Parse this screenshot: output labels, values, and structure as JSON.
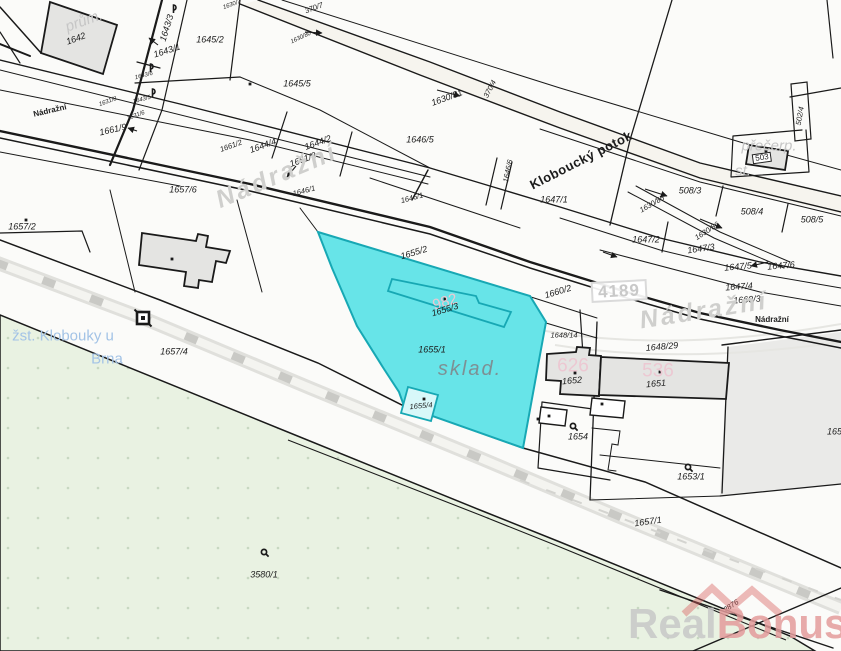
{
  "map": {
    "type": "cadastral-map",
    "selected_parcel": {
      "number": "1655/1",
      "area_use_label": "sklad.",
      "building_parcels": [
        "1655/3",
        "1655/4"
      ],
      "highlight_fill": "#67e4e8",
      "highlight_stroke": "#17a8b4"
    },
    "street_names": [
      "Nádražní"
    ],
    "stream_name": "Kloboucký potok",
    "station_name": {
      "line1": "žst. Klobouky u",
      "line2": "Brna"
    },
    "road_number": "4189",
    "labels": [
      {
        "t": "prům.",
        "x": 84,
        "y": 21,
        "r": -20,
        "c": "bname"
      },
      {
        "t": "1642",
        "x": 76,
        "y": 39,
        "r": -20,
        "c": "p"
      },
      {
        "t": "1643/3",
        "x": 167,
        "y": 28,
        "r": -73,
        "c": "p"
      },
      {
        "t": "1643/1",
        "x": 167,
        "y": 51,
        "r": -18,
        "c": "p"
      },
      {
        "t": "1643/6",
        "x": 144,
        "y": 76,
        "r": -15,
        "c": "pt"
      },
      {
        "t": "1643/5",
        "x": 142,
        "y": 100,
        "r": -15,
        "c": "pt"
      },
      {
        "t": "1645/2",
        "x": 210,
        "y": 40,
        "r": 0,
        "c": "p"
      },
      {
        "t": "1645/5",
        "x": 297,
        "y": 84,
        "r": 0,
        "c": "p"
      },
      {
        "t": "370/7",
        "x": 314,
        "y": 8,
        "r": -20,
        "c": "ps"
      },
      {
        "t": "1630/7",
        "x": 232,
        "y": 5,
        "r": -20,
        "c": "pt"
      },
      {
        "t": "1630/80",
        "x": 301,
        "y": 38,
        "r": -25,
        "c": "pt"
      },
      {
        "t": "1630/81",
        "x": 447,
        "y": 98,
        "r": -20,
        "c": "p"
      },
      {
        "t": "370/4",
        "x": 490,
        "y": 89,
        "r": -62,
        "c": "ps"
      },
      {
        "t": "1646/5",
        "x": 420,
        "y": 140,
        "r": 0,
        "c": "p"
      },
      {
        "t": "1644/4",
        "x": 263,
        "y": 146,
        "r": -20,
        "c": "p"
      },
      {
        "t": "1644/2",
        "x": 318,
        "y": 143,
        "r": -20,
        "c": "p"
      },
      {
        "t": "1661/8",
        "x": 303,
        "y": 160,
        "r": -20,
        "c": "p"
      },
      {
        "t": "1661/9",
        "x": 113,
        "y": 130,
        "r": -13,
        "c": "p"
      },
      {
        "t": "1661/2",
        "x": 231,
        "y": 146,
        "r": -20,
        "c": "ps"
      },
      {
        "t": "1631/8",
        "x": 108,
        "y": 102,
        "r": -20,
        "c": "pt"
      },
      {
        "t": "1631/6",
        "x": 136,
        "y": 116,
        "r": -20,
        "c": "pt"
      },
      {
        "t": "Nádražní",
        "x": 50,
        "y": 111,
        "r": -13,
        "c": "ssm"
      },
      {
        "t": "1646/1",
        "x": 304,
        "y": 191,
        "r": -15,
        "c": "ps"
      },
      {
        "t": "1646/1",
        "x": 412,
        "y": 198,
        "r": -15,
        "c": "ps"
      },
      {
        "t": "1646/6",
        "x": 508,
        "y": 171,
        "r": -78,
        "c": "ps"
      },
      {
        "t": "1657/6",
        "x": 183,
        "y": 190,
        "r": 0,
        "c": "p"
      },
      {
        "t": "1657/2",
        "x": 22,
        "y": 227,
        "r": 0,
        "c": "p"
      },
      {
        "t": "Nádražní",
        "x": 277,
        "y": 176,
        "r": -23,
        "c": "sbig"
      },
      {
        "t": "Kloboucký potok",
        "x": 581,
        "y": 160,
        "r": -27,
        "c": "stream"
      },
      {
        "t": "1647/1",
        "x": 554,
        "y": 200,
        "r": 0,
        "c": "p"
      },
      {
        "t": "508/3",
        "x": 690,
        "y": 191,
        "r": 0,
        "c": "p"
      },
      {
        "t": "1630/85",
        "x": 652,
        "y": 204,
        "r": -30,
        "c": "ps"
      },
      {
        "t": "508/4",
        "x": 752,
        "y": 212,
        "r": 0,
        "c": "p"
      },
      {
        "t": "508/5",
        "x": 812,
        "y": 220,
        "r": 0,
        "c": "p"
      },
      {
        "t": "1647/2",
        "x": 646,
        "y": 240,
        "r": 0,
        "c": "p"
      },
      {
        "t": "1630/86",
        "x": 707,
        "y": 231,
        "r": -33,
        "c": "ps"
      },
      {
        "t": "1647/3",
        "x": 701,
        "y": 249,
        "r": -8,
        "c": "p"
      },
      {
        "t": "1647/5",
        "x": 738,
        "y": 267,
        "r": -5,
        "c": "p"
      },
      {
        "t": "1647/6",
        "x": 781,
        "y": 266,
        "r": -5,
        "c": "p"
      },
      {
        "t": "4189",
        "x": 619,
        "y": 291,
        "r": -3,
        "c": "rnum"
      },
      {
        "t": "1647/4",
        "x": 739,
        "y": 287,
        "r": -4,
        "c": "p"
      },
      {
        "t": "1660/3",
        "x": 747,
        "y": 300,
        "r": -4,
        "c": "p"
      },
      {
        "t": "Nádražní",
        "x": 704,
        "y": 311,
        "r": -9,
        "c": "sbig"
      },
      {
        "t": "Nádražní",
        "x": 772,
        "y": 320,
        "r": 0,
        "c": "ssm"
      },
      {
        "t": "502/4",
        "x": 800,
        "y": 116,
        "r": -80,
        "c": "ps"
      },
      {
        "t": "přečerp.",
        "x": 769,
        "y": 146,
        "r": 0,
        "c": "bname"
      },
      {
        "t": "st.",
        "x": 743,
        "y": 171,
        "r": 0,
        "c": "bname"
      },
      {
        "t": "503",
        "x": 762,
        "y": 158,
        "r": -8,
        "c": "pbox"
      },
      {
        "t": "1655/2",
        "x": 414,
        "y": 253,
        "r": -17,
        "c": "p"
      },
      {
        "t": "1660/2",
        "x": 558,
        "y": 292,
        "r": -17,
        "c": "p"
      },
      {
        "t": "982",
        "x": 445,
        "y": 302,
        "r": -17,
        "c": "pink"
      },
      {
        "t": "1655/3",
        "x": 445,
        "y": 310,
        "r": -17,
        "c": "p"
      },
      {
        "t": "1655/1",
        "x": 432,
        "y": 350,
        "r": 0,
        "c": "p"
      },
      {
        "t": "sklad.",
        "x": 470,
        "y": 369,
        "r": 0,
        "c": "aname"
      },
      {
        "t": "1655/4",
        "x": 421,
        "y": 406,
        "r": -5,
        "c": "ps"
      },
      {
        "t": "1648/14",
        "x": 564,
        "y": 335,
        "r": 0,
        "c": "ps"
      },
      {
        "t": "1648/29",
        "x": 662,
        "y": 347,
        "r": -5,
        "c": "p"
      },
      {
        "t": "626",
        "x": 573,
        "y": 366,
        "r": 0,
        "c": "pinklg"
      },
      {
        "t": "1652",
        "x": 572,
        "y": 381,
        "r": -5,
        "c": "p"
      },
      {
        "t": "536",
        "x": 658,
        "y": 371,
        "r": 0,
        "c": "pinklg"
      },
      {
        "t": "1651",
        "x": 656,
        "y": 384,
        "r": -5,
        "c": "p"
      },
      {
        "t": "1654",
        "x": 578,
        "y": 437,
        "r": 0,
        "c": "p"
      },
      {
        "t": "1653/1",
        "x": 691,
        "y": 477,
        "r": 0,
        "c": "p"
      },
      {
        "t": "1655",
        "x": 837,
        "y": 432,
        "r": 0,
        "c": "p"
      },
      {
        "t": "žst. Klobouky u",
        "x": 63,
        "y": 336,
        "r": 0,
        "c": "station"
      },
      {
        "t": "Brna",
        "x": 107,
        "y": 359,
        "r": 0,
        "c": "station"
      },
      {
        "t": "1657/4",
        "x": 174,
        "y": 352,
        "r": 0,
        "c": "p"
      },
      {
        "t": "3580/1",
        "x": 264,
        "y": 575,
        "r": 0,
        "c": "p"
      },
      {
        "t": "1657/1",
        "x": 648,
        "y": 522,
        "r": -8,
        "c": "p"
      },
      {
        "t": "2876",
        "x": 731,
        "y": 606,
        "r": -34,
        "c": "ps"
      }
    ],
    "symbols": [
      {
        "type": "sapling",
        "x": 174,
        "y": 7
      },
      {
        "type": "sapling",
        "x": 151,
        "y": 66
      },
      {
        "type": "sapling",
        "x": 153,
        "y": 91
      },
      {
        "type": "meadow",
        "x": 573,
        "y": 426
      },
      {
        "type": "meadow",
        "x": 688,
        "y": 467
      },
      {
        "type": "meadow",
        "x": 264,
        "y": 552
      },
      {
        "type": "station",
        "x": 143,
        "y": 318
      }
    ],
    "building_dots": [
      [
        250,
        84
      ],
      [
        26,
        220
      ],
      [
        172,
        259
      ],
      [
        445,
        299
      ],
      [
        424,
        399
      ],
      [
        575,
        373
      ],
      [
        660,
        372
      ],
      [
        602,
        404
      ],
      [
        549,
        416
      ],
      [
        538,
        419
      ],
      [
        766,
        151
      ]
    ],
    "arrows": [
      [
        158,
        45,
        149,
        38
      ],
      [
        137,
        131,
        128,
        128
      ],
      [
        305,
        32,
        322,
        33
      ],
      [
        437,
        90,
        460,
        96
      ],
      [
        296,
        166,
        287,
        177
      ],
      [
        645,
        189,
        667,
        196
      ],
      [
        700,
        219,
        722,
        228
      ],
      [
        768,
        262,
        751,
        266
      ],
      [
        603,
        252,
        617,
        257
      ]
    ],
    "colors": {
      "highlight_fill": "#67e4e8",
      "highlight_stroke": "#17a8b4",
      "green_area": "#e9f2e2",
      "building_fill": "#e4e4e2",
      "pink_building_number": "#ecc8d2",
      "road_number_gray": "#c9c9c9",
      "station_label_blue": "#a3c3e6",
      "watermark_gray": "#c8c8c8",
      "watermark_red": "#e49c9c",
      "watermark_logo_red": "#d96060"
    }
  },
  "watermark": {
    "part_gray": "Real",
    "part_red": "Bonus",
    "suffix": ".c"
  }
}
